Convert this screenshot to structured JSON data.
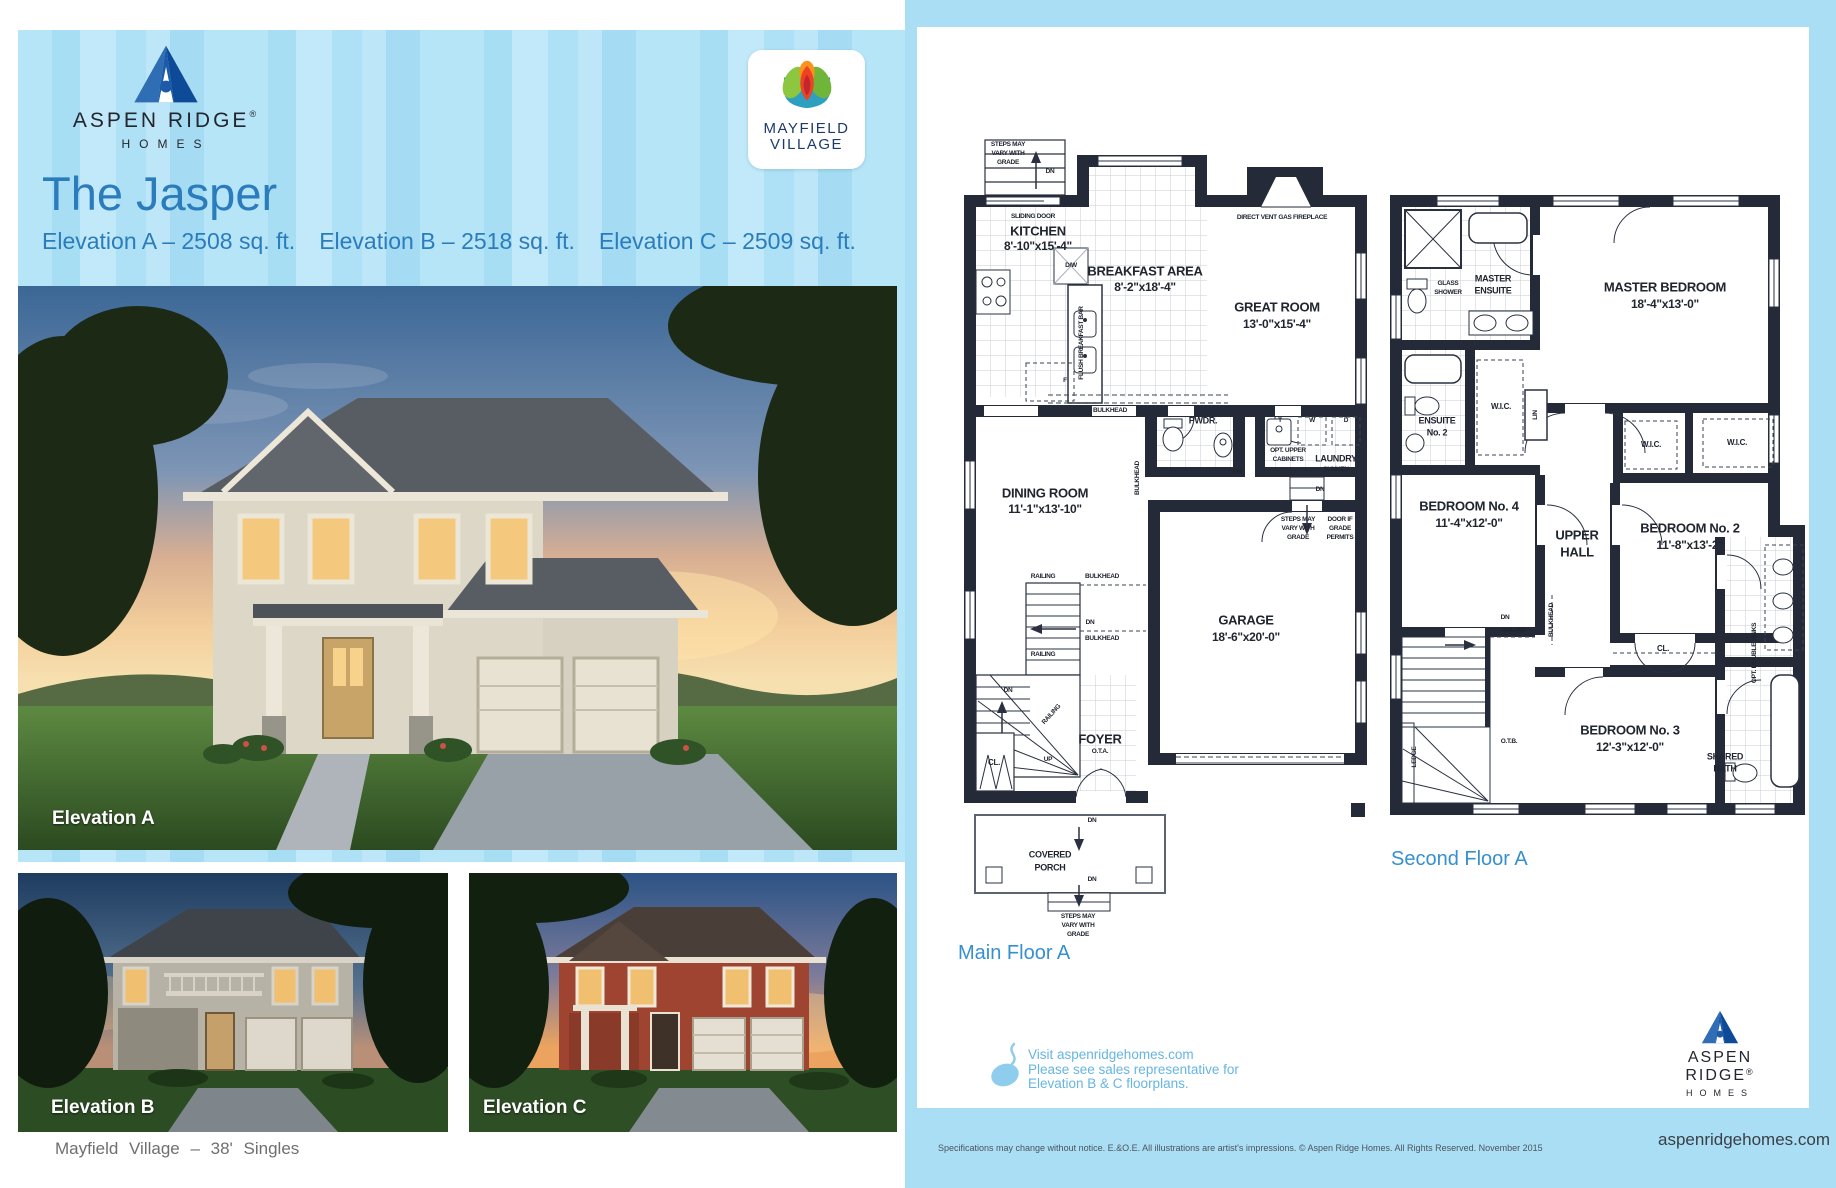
{
  "brand": {
    "name": "ASPEN RIDGE",
    "reg": "®",
    "homes": "HOMES"
  },
  "community_logo": {
    "line1": "MAYFIELD",
    "line2": "VILLAGE"
  },
  "header": {
    "title": "The Jasper",
    "elevations": [
      "Elevation A – 2508 sq. ft.",
      "Elevation B – 2518 sq. ft.",
      "Elevation C – 2509 sq. ft."
    ]
  },
  "photos": {
    "a_label": "Elevation A",
    "b_label": "Elevation B",
    "c_label": "Elevation C"
  },
  "footer_left": "Mayfield Village  –  38' Singles",
  "main_floor": {
    "caption": "Main Floor A",
    "labels": {
      "steps_a": "STEPS MAY",
      "steps_b": "VARY WITH",
      "steps_c": "GRADE",
      "dn": "DN",
      "up": "UP",
      "sliding": "SLIDING DOOR",
      "kitchen": "KITCHEN",
      "kitchen_dims": "8'-10\"x15'-4\"",
      "dw": "D/W",
      "flush_bar": "FLUSH BREAKFAST BAR",
      "fridge": "F",
      "breakfast": "BREAKFAST AREA",
      "breakfast_dims": "8'-2\"x18'-4\"",
      "fireplace": "DIRECT VENT GAS FIREPLACE",
      "great": "GREAT ROOM",
      "great_dims": "13'-0\"x15'-4\"",
      "bulkhead": "BULKHEAD",
      "pwdr": "PWDR.",
      "t": "T",
      "w": "W",
      "d": "D",
      "opt_upper_a": "OPT. UPPER",
      "opt_upper_b": "CABINETS",
      "laundry": "LAUNDRY",
      "laundry_sub": "SUNKEN",
      "dining": "DINING ROOM",
      "dining_dims": "11'-1\"x13'-10\"",
      "door_a": "DOOR IF",
      "door_b": "GRADE",
      "door_c": "PERMITS",
      "railing": "RAILING",
      "garage": "GARAGE",
      "garage_dims": "18'-6\"x20'-0\"",
      "foyer": "FOYER",
      "foyer_sub": "O.T.A.",
      "cl": "CL.",
      "porch_a": "COVERED",
      "porch_b": "PORCH"
    }
  },
  "second_floor": {
    "caption": "Second Floor A",
    "labels": {
      "glass_a": "GLASS",
      "glass_b": "SHOWER",
      "mens_a": "MASTER",
      "mens_b": "ENSUITE",
      "master": "MASTER BEDROOM",
      "master_dims": "18'-4\"x13'-0\"",
      "ens2_a": "ENSUITE",
      "ens2_b": "No. 2",
      "wic": "W.I.C.",
      "lin": "LIN",
      "bed4": "BEDROOM No. 4",
      "bed4_dims": "11'-4\"x12'-0\"",
      "hall_a": "UPPER",
      "hall_b": "HALL",
      "bed2": "BEDROOM No. 2",
      "bed2_dims": "11'-8\"x13'-2\"",
      "dn": "DN",
      "railing": "RAILING",
      "bulkhead": "BULKHEAD",
      "cl": "CL.",
      "opt_sinks": "OPT. DOUBLE SINKS",
      "bed3": "BEDROOM No. 3",
      "bed3_dims": "12'-3\"x12'-0\"",
      "otb": "O.T.B.",
      "ledge": "LEDGE",
      "shared_a": "SHARED",
      "shared_b": "BATH"
    }
  },
  "note": {
    "lines": [
      "Visit aspenridgehomes.com",
      "Please see sales representative for",
      "Elevation B & C floorplans."
    ]
  },
  "legal": "Specifications may change without notice. E.&O.E. All illustrations are artist's impressions. © Aspen Ridge Homes. All Rights Reserved. November 2015",
  "website": "aspenridgehomes.com",
  "colors": {
    "accent_blue": "#2b7cbc",
    "caption_blue": "#3690cf",
    "page_blue": "#a9def4",
    "plan_ink": "#242a38",
    "note_blue": "#66b5e3",
    "navy": "#0d4a97"
  }
}
